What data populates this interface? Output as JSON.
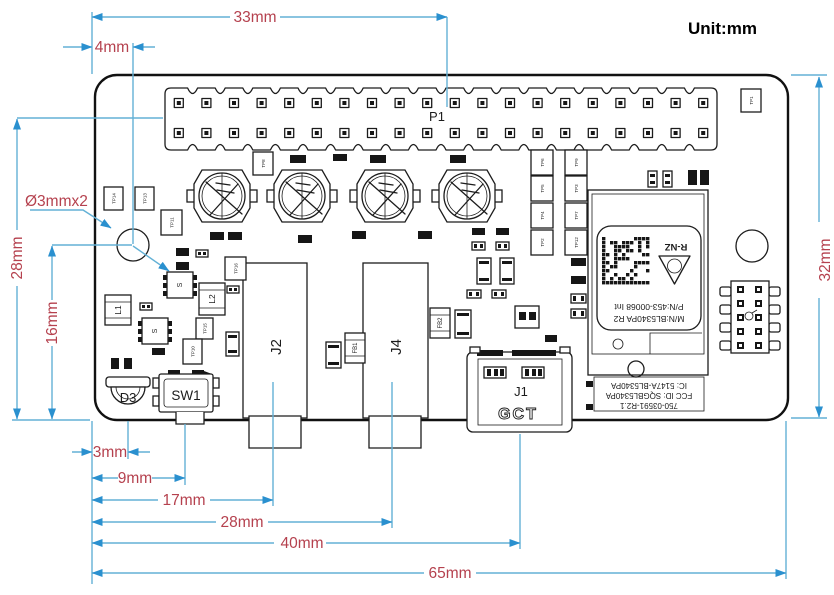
{
  "unit_label": "Unit:mm",
  "dimensions": {
    "p1_offset_x": "33mm",
    "hole_offset_x": "4mm",
    "hole_callout": "Ø3mmx2",
    "p1_offset_y": "28mm",
    "hole_offset_y": "16mm",
    "board_height": "32mm",
    "d3_offset": "3mm",
    "sw1_offset": "9mm",
    "j2_offset": "17mm",
    "j4_offset": "28mm",
    "j1_offset": "40mm",
    "board_width": "65mm"
  },
  "components": {
    "header": "P1",
    "jack_left": "J2",
    "jack_right": "J4",
    "usb": "J1",
    "usb_brand": "GCT",
    "switch": "SW1",
    "led": "D3",
    "inductor1": "L1",
    "inductor2": "L2",
    "ferrite1": "FB1",
    "ferrite2": "FB2",
    "chip_mark": "S",
    "testpoints": [
      "TP1",
      "TP8",
      "TP6",
      "TP5",
      "TP4",
      "TP2",
      "TP9",
      "TP3",
      "TP7",
      "TP12",
      "TP14",
      "TP13",
      "TP11",
      "TP15",
      "TP10",
      "TP16"
    ]
  },
  "module": {
    "cert_mark": "R-NZ",
    "model": "M/N:BL5340PA R2",
    "part": "P/N:453-00068 Int",
    "fcc_lines": [
      "750-03591-R2.1",
      "FCC ID: SQGBL5340PA",
      "IC: 5147A-BL5340PA"
    ]
  },
  "colors": {
    "dimension_line": "#63b1d6",
    "dimension_arrow": "#2a90cf",
    "dimension_text": "#b5414e",
    "linework": "#1c1c1c",
    "background": "#ffffff"
  }
}
